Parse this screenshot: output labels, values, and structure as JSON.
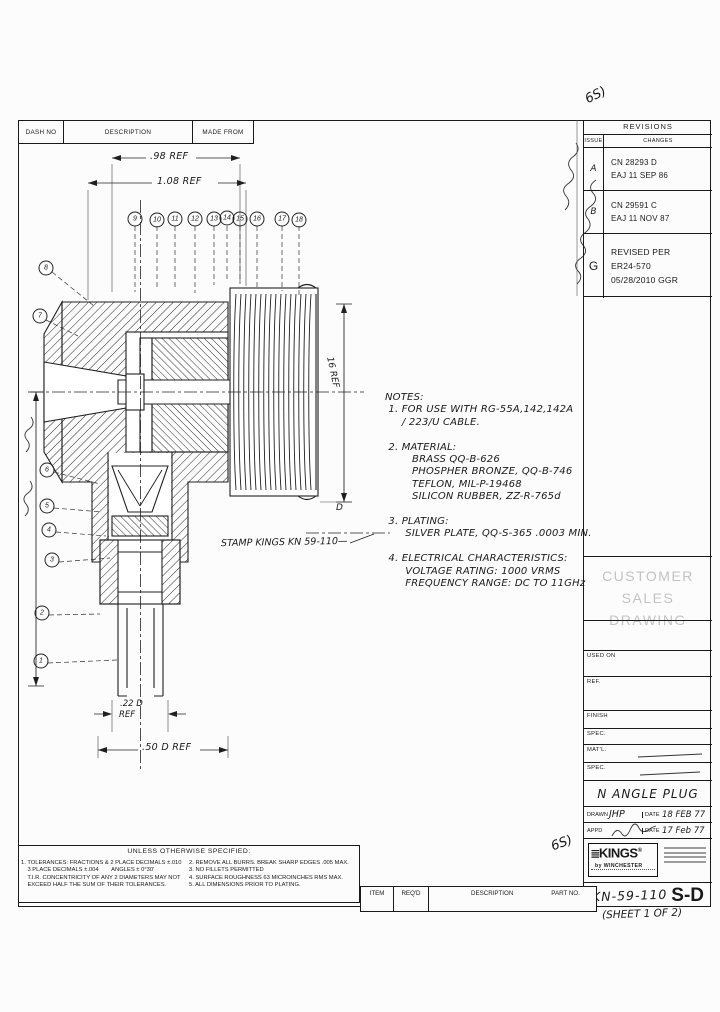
{
  "dash_table": {
    "col1": "DASH NO",
    "col2": "DESCRIPTION",
    "col3": "MADE FROM"
  },
  "revisions": {
    "title": "REVISIONS",
    "issue_col": "ISSUE",
    "changes_col": "CHANGES",
    "rows": [
      {
        "issue": "A",
        "line1": "CN 28293 D",
        "line2": "EAJ 11 SEP 86"
      },
      {
        "issue": "B",
        "line1": "CN 29591 C",
        "line2": "EAJ 11 NOV 87"
      },
      {
        "issue": "G",
        "line1": "REVISED PER",
        "line2": "ER24-570",
        "line3": "05/28/2010 GGR"
      }
    ]
  },
  "watermark": {
    "line1": "CUSTOMER",
    "line2": "SALES DRAWING"
  },
  "title_block": {
    "fields": {
      "used_on": "USED ON",
      "ref": "REF.",
      "finish": "FINISH",
      "spec1": "SPEC.",
      "matl": "MAT'L.",
      "spec2": "SPEC."
    },
    "title": "N ANGLE PLUG",
    "drawn_label": "DRAWN",
    "drawn_value": "JHP",
    "date_label": "DATE",
    "drawn_date": "18 FEB 77",
    "appd_label": "APPD",
    "appd_date": "17 Feb 77",
    "logo": {
      "name": "KINGS",
      "reg": "®",
      "sub": "by WINCHESTER"
    },
    "part_number": "KN-59-110",
    "part_suffix": "S-D",
    "sheet_note": "(SHEET 1 OF 2)"
  },
  "notes": {
    "lines": [
      "NOTES:",
      " 1. FOR USE WITH RG-55A,142,142A",
      "     / 223/U CABLE.",
      "",
      " 2. MATERIAL:",
      "        BRASS QQ-B-626",
      "        PHOSPHER BRONZE, QQ-B-746",
      "        TEFLON, MIL-P-19468",
      "        SILICON RUBBER, ZZ-R-765d",
      "",
      " 3. PLATING:",
      "      SILVER PLATE, QQ-S-365 .0003 MIN.",
      "",
      " 4. ELECTRICAL CHARACTERISTICS:",
      "      VOLTAGE RATING: 1000 VRMS",
      "      FREQUENCY RANGE: DC TO 11GHz"
    ]
  },
  "dimensions": {
    "dim1": ".98 REF",
    "dim2": "1.08 REF",
    "dim3_line1": ".22 D",
    "dim3_line2": "REF",
    "dim4": ".50 D REF",
    "dim5": "16 REF",
    "d_mark": "D",
    "stamp": "STAMP KINGS KN 59-110—"
  },
  "uos": {
    "title": "UNLESS OTHERWISE SPECIFIED:",
    "left": [
      "1. TOLERANCES: FRACTIONS & 2 PLACE DECIMALS ±.010",
      "    3 PLACE DECIMALS ±.004        ANGLES ± 0°30'",
      "    T.I.R. CONCENTRICITY OF ANY 2 DIAMETERS MAY NOT",
      "    EXCEED HALF THE SUM OF THEIR TOLERANCES."
    ],
    "right": [
      "2. REMOVE ALL BURRS. BREAK SHARP EDGES .005 MAX.",
      "3. NO FILLETS PERMITTED",
      "4. SURFACE ROUGHNESS 63 MICROINCHES RMS MAX.",
      "5. ALL DIMENSIONS PRIOR TO PLATING."
    ]
  },
  "parts_strip": {
    "item": "ITEM",
    "reqd": "REQ'D",
    "description": "DESCRIPTION",
    "part_no": "PART NO."
  },
  "annotations": {
    "mark_top": "6S)",
    "mark_mid": "6S)"
  },
  "drawing": {
    "balloons": [
      {
        "n": 9,
        "x": 135,
        "y": 219
      },
      {
        "n": 10,
        "x": 157,
        "y": 220
      },
      {
        "n": 11,
        "x": 175,
        "y": 219
      },
      {
        "n": 12,
        "x": 195,
        "y": 219
      },
      {
        "n": 13,
        "x": 214,
        "y": 219
      },
      {
        "n": 14,
        "x": 227,
        "y": 218
      },
      {
        "n": 15,
        "x": 240,
        "y": 219
      },
      {
        "n": 16,
        "x": 257,
        "y": 219
      },
      {
        "n": 17,
        "x": 282,
        "y": 219
      },
      {
        "n": 18,
        "x": 299,
        "y": 220
      },
      {
        "n": 8,
        "x": 46,
        "y": 268
      },
      {
        "n": 7,
        "x": 40,
        "y": 316
      },
      {
        "n": 6,
        "x": 47,
        "y": 470
      },
      {
        "n": 5,
        "x": 47,
        "y": 506
      },
      {
        "n": 4,
        "x": 49,
        "y": 530
      },
      {
        "n": 3,
        "x": 52,
        "y": 560
      },
      {
        "n": 2,
        "x": 42,
        "y": 613
      },
      {
        "n": 1,
        "x": 41,
        "y": 661
      }
    ]
  }
}
